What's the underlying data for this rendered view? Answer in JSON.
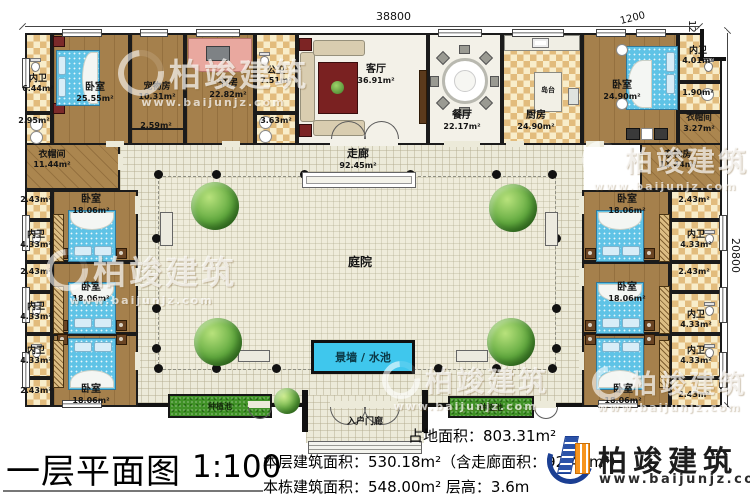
{
  "dims": {
    "top": "38800",
    "corner_h": "1200",
    "corner_v": "1200",
    "right": "20800"
  },
  "rooms": {
    "neiwei_tl": {
      "name": "内卫",
      "area": "6.44m²"
    },
    "a295": {
      "area": "2.95m²"
    },
    "bed_tl": {
      "name": "卧室",
      "area": "25.55m²"
    },
    "pet": {
      "name": "宠物房",
      "area": "10.31m²"
    },
    "a259": {
      "area": "2.59m²"
    },
    "study": {
      "name": "书房",
      "area": "22.82m²"
    },
    "gongwei": {
      "name": "公卫",
      "area": "7.51m²"
    },
    "a363": {
      "area": "3.63m²"
    },
    "living": {
      "name": "客厅",
      "area": "36.91m²"
    },
    "dining": {
      "name": "餐厅",
      "area": "22.17m²"
    },
    "kitchen": {
      "name": "厨房",
      "area": "24.90m²"
    },
    "island": {
      "name": "岛台"
    },
    "bed_tr": {
      "name": "卧室",
      "area": "24.90m²"
    },
    "neiwei_tr": {
      "name": "内卫",
      "area": "4.01m²"
    },
    "a190": {
      "area": "1.90m²"
    },
    "cloak_tr": {
      "name": "衣帽间",
      "area": "3.27m²"
    },
    "storage": {
      "name": "杂物房",
      "area": "11.44m²"
    },
    "cloak_tl": {
      "name": "衣帽间",
      "area": "11.44m²"
    },
    "corridor": {
      "name": "走廊",
      "area": "92.45m²"
    },
    "courtyard": {
      "name": "庭院"
    },
    "water": {
      "name": "景墙 / 水池"
    },
    "porch": {
      "name": "入户门廊"
    },
    "plant_left": {
      "name": "种植池"
    },
    "plant_right": {
      "name": "种植池"
    }
  },
  "suites": {
    "left": [
      {
        "small": "2.43m²",
        "bath_name": "内卫",
        "bath_area": "4.33m²",
        "bed_name": "卧室",
        "bed_area": "18.06m²"
      },
      {
        "small": "2.43m²",
        "bath_name": "内卫",
        "bath_area": "4.33m²",
        "bed_name": "卧室",
        "bed_area": "18.06m²"
      },
      {
        "small": "2.43m²",
        "bath_name": "内卫",
        "bath_area": "4.33m²",
        "bed_name": "卧室",
        "bed_area": "18.06m²"
      }
    ],
    "right": [
      {
        "small": "2.43m²",
        "bath_name": "内卫",
        "bath_area": "4.33m²",
        "bed_name": "卧室",
        "bed_area": "18.06m²"
      },
      {
        "small": "2.43m²",
        "bath_name": "内卫",
        "bath_area": "4.33m²",
        "bed_name": "卧室",
        "bed_area": "18.06m²"
      },
      {
        "small": "2.43m²",
        "bath_name": "内卫",
        "bath_area": "4.33m²",
        "bed_name": "卧室",
        "bed_area": "18.06m²"
      }
    ]
  },
  "footer": {
    "title": "一层平面图",
    "scale": "1:100",
    "land": "占地面积：803.31m²",
    "floor": "本层建筑面积：530.18m²（含走廊面积：92.45m²）",
    "building": "本栋建筑面积：548.00m²",
    "height": "层高：3.6m"
  },
  "brand": {
    "name": "柏竣建筑",
    "site": "www.baijunjz.com"
  }
}
